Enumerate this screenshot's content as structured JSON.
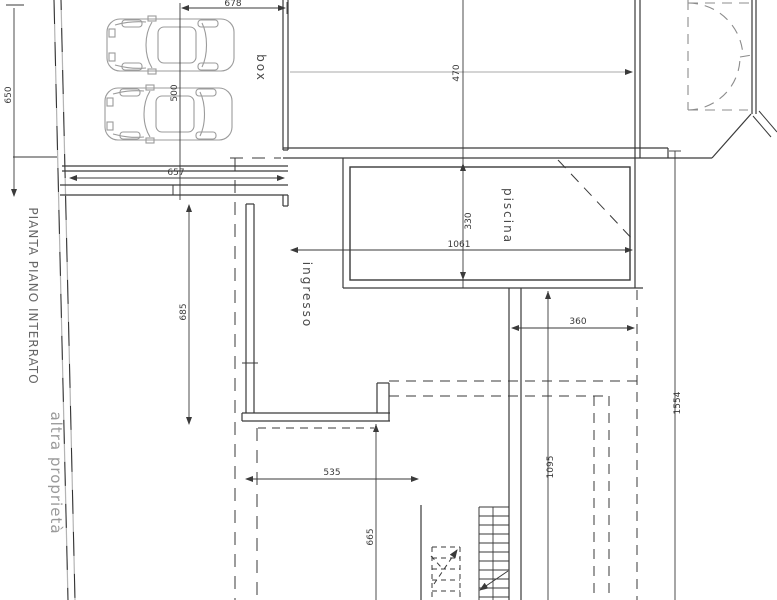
{
  "labels": {
    "plan_title": "PIANTA PIANO INTERRATO",
    "other_property": "altra proprietà",
    "garage": "box",
    "pool": "piscina",
    "entrance": "ingresso"
  },
  "dims": {
    "garage_width_top": "678",
    "left_depth": "650",
    "garage_width_bottom": "657",
    "garage_depth": "500",
    "corridor_depth": "685",
    "room_width": "470",
    "pool_width": "330",
    "pool_length": "1061",
    "terrace_width": "360",
    "right_depth": "1095",
    "site_depth": "1554",
    "lower_width": "535",
    "lower_depth": "665"
  }
}
